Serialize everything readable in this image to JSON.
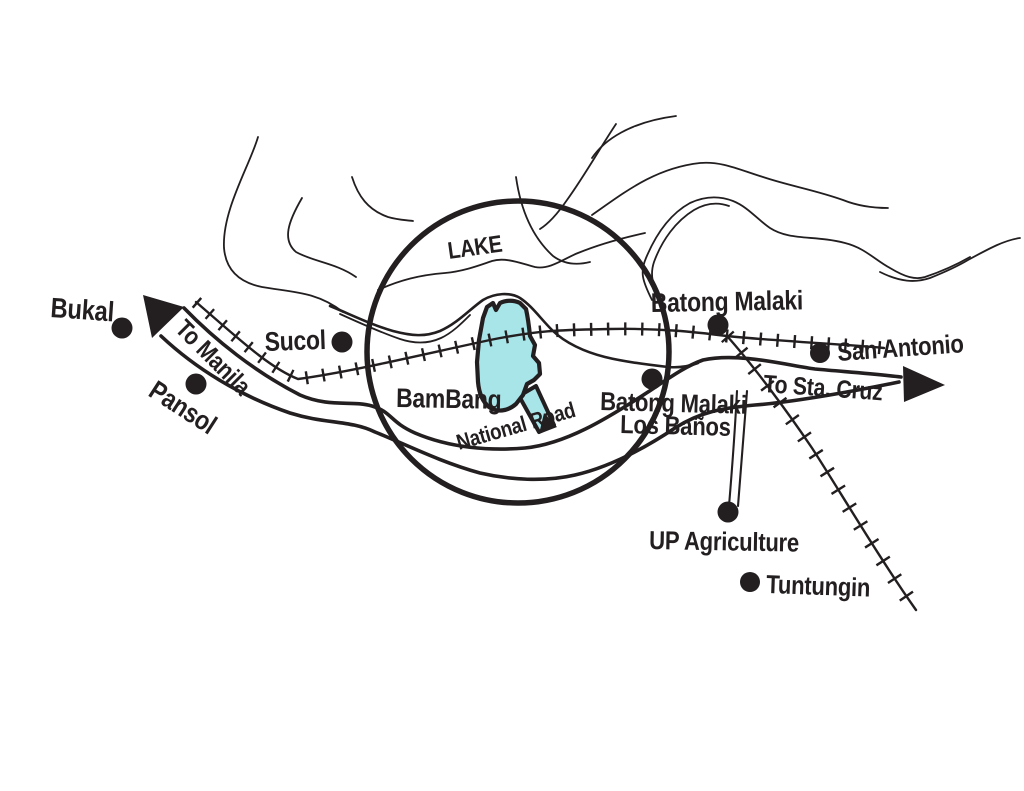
{
  "map": {
    "colors": {
      "ink": "#231f20",
      "highlight_fill": "#a8e5e9",
      "background": "#ffffff"
    },
    "water": {
      "lake_label": "LAKE"
    },
    "roads": {
      "to_manila_label": "To Manila",
      "national_road_label": "National Road",
      "to_sta_cruz_label": "To Sta. Cruz"
    },
    "places": {
      "bukal": "Bukal",
      "pansol": "Pansol",
      "sucol": "Sucol",
      "bambang": "BamBang",
      "batong_malaki_north": "Batong Malaki",
      "san_antonio": "San Antonio",
      "batong_malaki_south_line1": "Batong Malaki",
      "batong_malaki_south_line2": "Los Baños",
      "up_agriculture": "UP Agriculture",
      "tuntungin": "Tuntungin"
    }
  }
}
